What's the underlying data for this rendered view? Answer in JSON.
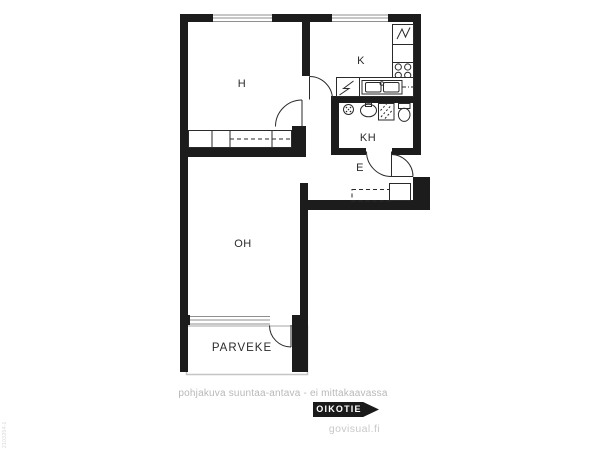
{
  "plan": {
    "rooms": {
      "h": "H",
      "k": "K",
      "kh": "KH",
      "e": "E",
      "oh": "OH",
      "parveke": "PARVEKE"
    },
    "fixtures": {
      "kitchen": [
        "fridge-icon",
        "stove-icon",
        "sink-icon",
        "dishwasher-icon"
      ],
      "bathroom": [
        "shower-icon",
        "washbasin-icon",
        "washing-machine-icon",
        "toilet-icon"
      ]
    },
    "colors": {
      "wall": "#1c1c1c",
      "line": "#2a2a2a",
      "window_line": "#8f8f8f",
      "balcony_outline": "#c4c4c4"
    }
  },
  "footer": {
    "disclaimer": "pohjakuva suuntaa-antava - ei mittakaavassa",
    "brand": "OIKOTIE",
    "site": "govisual.fi"
  },
  "watermark": "2103254-1"
}
